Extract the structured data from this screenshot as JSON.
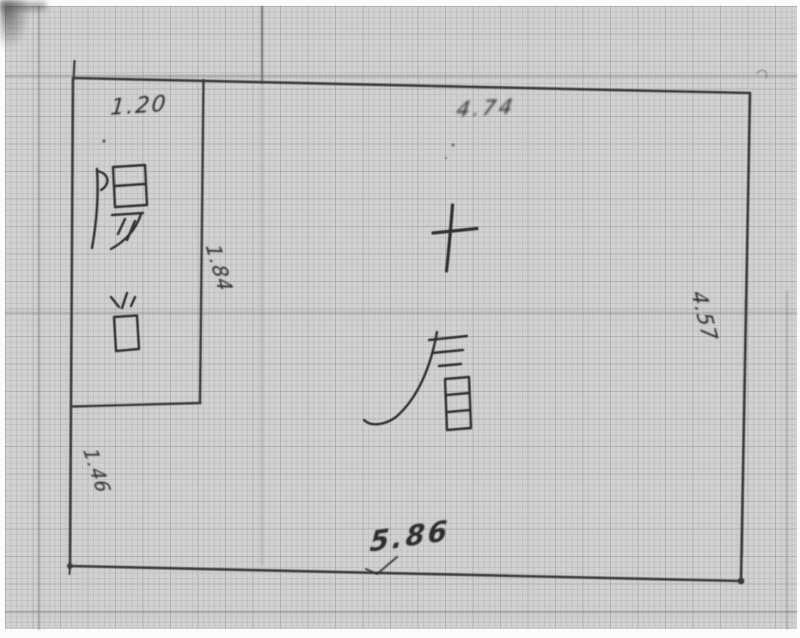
{
  "sketch": {
    "kind": "hand-drawn floor plan on graph paper",
    "room": {
      "label": "十層"
    },
    "balcony": {
      "label": "陽台"
    },
    "dims": {
      "balcony_width": "1.20",
      "main_top_width": "4.74",
      "right_height": "4.57",
      "balcony_inner_wall": "1.84",
      "left_below_balcony": "1.46",
      "overall_bottom_width": "5.86"
    },
    "colors": {
      "paper": "#d4d4d3",
      "ink": "#343434",
      "grid_fine": "#c4c8c8",
      "grid_major": "#aeb3b3"
    }
  }
}
